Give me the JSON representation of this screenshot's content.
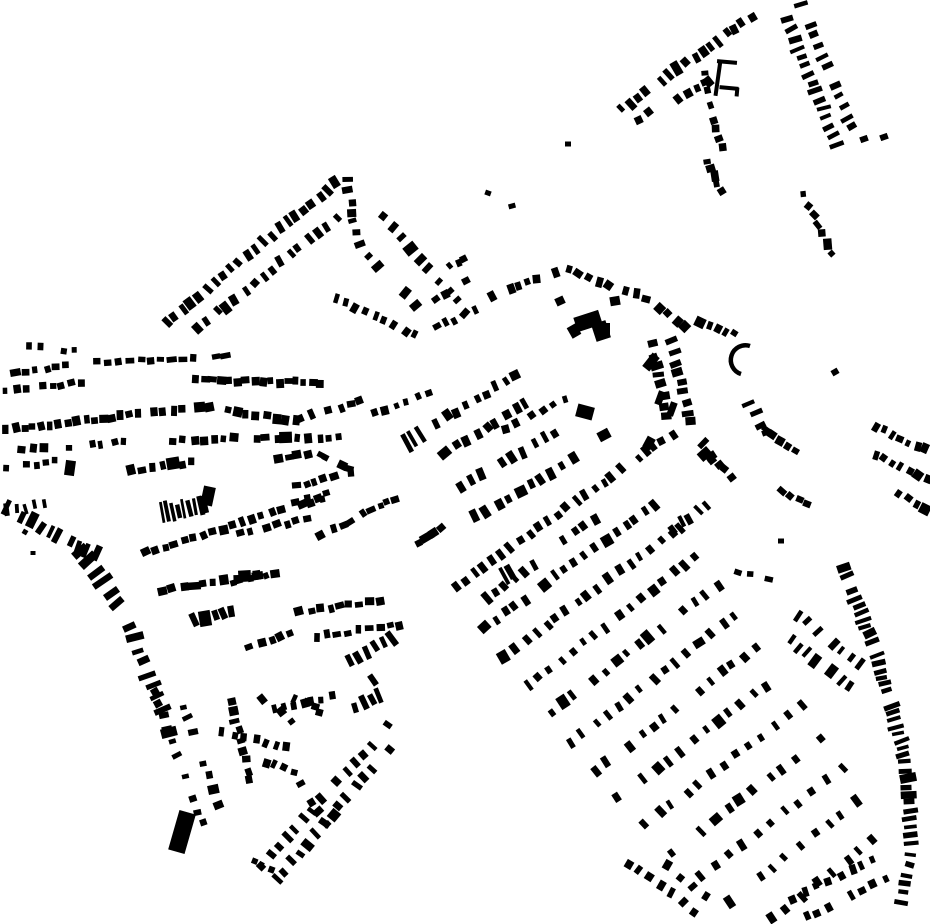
{
  "map": {
    "width": 930,
    "height": 924,
    "background_color": "#ffffff",
    "building_color": "#000000",
    "kind": "figure-ground building footprint map",
    "rows": [
      [
        618,
        112,
        755,
        14,
        17,
        6,
        10,
        10,
        0.06
      ],
      [
        633,
        122,
        712,
        80,
        8,
        6,
        9,
        12,
        0.15
      ],
      [
        703,
        68,
        722,
        150,
        10,
        6,
        7,
        14,
        0.08
      ],
      [
        706,
        158,
        722,
        196,
        5,
        6,
        7,
        14,
        0.1
      ],
      [
        782,
        8,
        838,
        148,
        16,
        5,
        12,
        8,
        0.06
      ],
      [
        800,
        0,
        854,
        132,
        13,
        5,
        11,
        8,
        0.12
      ],
      [
        797,
        180,
        835,
        258,
        8,
        7,
        6,
        25,
        0.1
      ],
      [
        348,
        173,
        162,
        325,
        23,
        6,
        10,
        10,
        0.05
      ],
      [
        340,
        215,
        185,
        338,
        17,
        6,
        9,
        10,
        0.1
      ],
      [
        346,
        176,
        359,
        248,
        7,
        6,
        9,
        10,
        0.05
      ],
      [
        372,
        200,
        470,
        318,
        11,
        6,
        9,
        12,
        0.08
      ],
      [
        363,
        250,
        420,
        310,
        6,
        6,
        9,
        12,
        0.1
      ],
      [
        330,
        295,
        420,
        338,
        9,
        6,
        9,
        12,
        0.08
      ],
      [
        480,
        300,
        560,
        272,
        9,
        7,
        8,
        14,
        0.1
      ],
      [
        565,
        268,
        650,
        300,
        9,
        7,
        8,
        14,
        0.1
      ],
      [
        655,
        305,
        690,
        330,
        4,
        7,
        8,
        14,
        0.1
      ],
      [
        648,
        330,
        668,
        420,
        9,
        6,
        10,
        10,
        0.08
      ],
      [
        670,
        337,
        692,
        428,
        9,
        6,
        10,
        10,
        0.08
      ],
      [
        692,
        430,
        722,
        468,
        4,
        6,
        10,
        10,
        0.1
      ],
      [
        700,
        448,
        736,
        482,
        4,
        6,
        9,
        10,
        0.1
      ],
      [
        668,
        533,
        720,
        496,
        6,
        5,
        10,
        10,
        0.08
      ],
      [
        735,
        572,
        772,
        580,
        4,
        7,
        5,
        10,
        0.1
      ],
      [
        795,
        612,
        865,
        668,
        8,
        5,
        10,
        9,
        0.08
      ],
      [
        786,
        636,
        852,
        690,
        8,
        5,
        10,
        9,
        0.1
      ],
      [
        762,
        425,
        800,
        455,
        5,
        7,
        7,
        12,
        0.08
      ],
      [
        780,
        488,
        812,
        508,
        4,
        7,
        7,
        12,
        0.08
      ],
      [
        862,
        420,
        930,
        452,
        8,
        6,
        8,
        10,
        0.12
      ],
      [
        872,
        452,
        930,
        482,
        7,
        6,
        8,
        10,
        0.12
      ],
      [
        884,
        484,
        930,
        512,
        5,
        6,
        8,
        10,
        0.15
      ],
      [
        25,
        345,
        80,
        352,
        5,
        6,
        6,
        15,
        0.15
      ],
      [
        12,
        372,
        70,
        366,
        6,
        6,
        7,
        12,
        0.1
      ],
      [
        2,
        390,
        85,
        383,
        9,
        6,
        7,
        10,
        0.08
      ],
      [
        2,
        430,
        143,
        414,
        16,
        7,
        8,
        8,
        0.05
      ],
      [
        150,
        412,
        215,
        407,
        7,
        7,
        8,
        8,
        0.06
      ],
      [
        222,
        410,
        300,
        422,
        8,
        7,
        8,
        8,
        0.1
      ],
      [
        18,
        450,
        130,
        442,
        10,
        6,
        7,
        12,
        0.2
      ],
      [
        92,
        362,
        230,
        357,
        13,
        8,
        6,
        10,
        0.15
      ],
      [
        192,
        380,
        325,
        383,
        16,
        7,
        7,
        6,
        0.02
      ],
      [
        159,
        514,
        208,
        503,
        9,
        3.5,
        17,
        4,
        0.04
      ],
      [
        2,
        505,
        62,
        538,
        7,
        5,
        13,
        8,
        0.08
      ],
      [
        66,
        540,
        100,
        556,
        4,
        5,
        12,
        8,
        0.1
      ],
      [
        76,
        546,
        128,
        618,
        7,
        7,
        18,
        7,
        0.05
      ],
      [
        128,
        620,
        172,
        740,
        10,
        6,
        14,
        8,
        0.08
      ],
      [
        152,
        688,
        205,
        830,
        12,
        6,
        8,
        10,
        0.15
      ],
      [
        176,
        684,
        222,
        812,
        9,
        6,
        8,
        12,
        0.25
      ],
      [
        3,
        512,
        48,
        503,
        5,
        4,
        11,
        8,
        0.1
      ],
      [
        168,
        440,
        355,
        437,
        18,
        7,
        8,
        7,
        0.06
      ],
      [
        118,
        472,
        196,
        462,
        8,
        7,
        8,
        9,
        0.1
      ],
      [
        273,
        460,
        312,
        454,
        4,
        7,
        7,
        9,
        0.1
      ],
      [
        315,
        452,
        355,
        470,
        5,
        7,
        7,
        9,
        0.1
      ],
      [
        140,
        555,
        325,
        497,
        19,
        7,
        8,
        8,
        0.06
      ],
      [
        158,
        592,
        260,
        574,
        10,
        7,
        8,
        8,
        0.1
      ],
      [
        295,
        420,
        365,
        400,
        7,
        7,
        8,
        10,
        0.1
      ],
      [
        370,
        414,
        432,
        392,
        6,
        6,
        7,
        12,
        0.1
      ],
      [
        402,
        446,
        426,
        432,
        3,
        4,
        16,
        5,
        0.05
      ],
      [
        292,
        487,
        355,
        472,
        7,
        7,
        7,
        9,
        0.08
      ],
      [
        292,
        505,
        332,
        492,
        4,
        7,
        7,
        9,
        0.1
      ],
      [
        235,
        535,
        310,
        518,
        8,
        7,
        7,
        10,
        0.1
      ],
      [
        315,
        538,
        355,
        520,
        5,
        7,
        7,
        10,
        0.1
      ],
      [
        360,
        515,
        400,
        496,
        5,
        7,
        7,
        10,
        0.1
      ],
      [
        408,
        548,
        445,
        525,
        5,
        7,
        7,
        10,
        0.1
      ],
      [
        228,
        585,
        288,
        569,
        7,
        7,
        7,
        9,
        0.08
      ],
      [
        182,
        625,
        237,
        608,
        6,
        7,
        12,
        8,
        0.06
      ],
      [
        245,
        650,
        296,
        630,
        5,
        7,
        7,
        10,
        0.1
      ],
      [
        295,
        612,
        385,
        600,
        9,
        7,
        7,
        9,
        0.08
      ],
      [
        300,
        638,
        405,
        625,
        10,
        7,
        7,
        9,
        0.08
      ],
      [
        345,
        665,
        395,
        636,
        6,
        5,
        13,
        7,
        0.08
      ],
      [
        350,
        708,
        383,
        694,
        4,
        5,
        12,
        8,
        0.1
      ],
      [
        230,
        695,
        251,
        786,
        9,
        6,
        8,
        10,
        0.1
      ],
      [
        258,
        694,
        296,
        724,
        4,
        7,
        7,
        20,
        0.1
      ],
      [
        292,
        696,
        326,
        714,
        4,
        6,
        7,
        20,
        0.15
      ],
      [
        270,
        710,
        336,
        696,
        7,
        6,
        7,
        10,
        0.1
      ],
      [
        218,
        730,
        292,
        748,
        7,
        6,
        8,
        10,
        0.1
      ],
      [
        252,
        756,
        298,
        774,
        5,
        6,
        7,
        10,
        0.1
      ],
      [
        296,
        778,
        330,
        828,
        5,
        6,
        8,
        10,
        0.1
      ],
      [
        250,
        858,
        274,
        872,
        3,
        6,
        7,
        12,
        0.1
      ],
      [
        258,
        870,
        392,
        722,
        16,
        5.5,
        10,
        7,
        0.06
      ],
      [
        272,
        884,
        400,
        737,
        16,
        5.5,
        10,
        7,
        0.06
      ],
      [
        432,
        426,
        521,
        372,
        9,
        6,
        9,
        10,
        0.08
      ],
      [
        441,
        456,
        531,
        400,
        9,
        6,
        9,
        10,
        0.08
      ],
      [
        455,
        490,
        560,
        430,
        10,
        6,
        10,
        8,
        0.06
      ],
      [
        470,
        520,
        580,
        456,
        10,
        6,
        10,
        8,
        0.06
      ],
      [
        500,
        430,
        570,
        396,
        6,
        6,
        7,
        12,
        0.2
      ],
      [
        432,
        300,
        470,
        280,
        4,
        6,
        7,
        12,
        0.1
      ],
      [
        432,
        330,
        478,
        308,
        5,
        6,
        7,
        12,
        0.1
      ],
      [
        447,
        268,
        468,
        256,
        3,
        5,
        6,
        12,
        0.1
      ],
      [
        695,
        320,
        748,
        338,
        6,
        6,
        7,
        15,
        0.1
      ],
      [
        748,
        400,
        768,
        438,
        4,
        5,
        11,
        8,
        0.1
      ],
      [
        500,
        578,
        516,
        570,
        2,
        4,
        15,
        5,
        0
      ],
      [
        2,
        468,
        60,
        461,
        6,
        6,
        6,
        12,
        0.25
      ],
      [
        452,
        590,
        570,
        505,
        13,
        5.5,
        9,
        8,
        0.06
      ],
      [
        573,
        503,
        676,
        432,
        12,
        5.5,
        9,
        8,
        0.06
      ],
      [
        470,
        610,
        600,
        515,
        13,
        5.5,
        9,
        8,
        0.2
      ],
      [
        480,
        632,
        660,
        500,
        18,
        5.5,
        9,
        7,
        0.08
      ],
      [
        500,
        660,
        686,
        522,
        18,
        5.5,
        9,
        7,
        0.1
      ],
      [
        522,
        690,
        702,
        552,
        16,
        5.5,
        9,
        7,
        0.08
      ],
      [
        545,
        717,
        722,
        582,
        16,
        5.5,
        9,
        7,
        0.08
      ],
      [
        566,
        746,
        740,
        612,
        15,
        5.5,
        9,
        7,
        0.08
      ],
      [
        590,
        776,
        762,
        642,
        15,
        5.5,
        9,
        7,
        0.08
      ],
      [
        613,
        801,
        786,
        671,
        14,
        5.5,
        9,
        7,
        0.08
      ],
      [
        640,
        828,
        808,
        701,
        13,
        5.5,
        9,
        7,
        0.08
      ],
      [
        666,
        856,
        830,
        731,
        12,
        5.5,
        9,
        7,
        0.08
      ],
      [
        696,
        881,
        848,
        763,
        11,
        5.5,
        9,
        7,
        0.1
      ],
      [
        726,
        906,
        862,
        796,
        10,
        5.5,
        9,
        7,
        0.1
      ],
      [
        766,
        924,
        882,
        832,
        8,
        5.5,
        9,
        7,
        0.1
      ],
      [
        788,
        900,
        880,
        856,
        8,
        6,
        8,
        9,
        0.1
      ],
      [
        800,
        920,
        892,
        876,
        8,
        6,
        8,
        9,
        0.1
      ],
      [
        622,
        858,
        700,
        915,
        7,
        6,
        8,
        10,
        0.2
      ],
      [
        648,
        850,
        710,
        900,
        5,
        6,
        8,
        12,
        0.3
      ],
      [
        843,
        565,
        878,
        660,
        13,
        4.5,
        13,
        6,
        0.05
      ],
      [
        878,
        660,
        905,
        758,
        14,
        4.5,
        13,
        6,
        0.05
      ],
      [
        905,
        758,
        913,
        846,
        11,
        4.5,
        12,
        6,
        0.05
      ],
      [
        911,
        850,
        899,
        918,
        7,
        4.5,
        11,
        8,
        0.2
      ]
    ],
    "blocks": [
      [
        588,
        321,
        26,
        15,
        -18
      ],
      [
        601,
        331,
        15,
        18,
        -18
      ],
      [
        574,
        331,
        10,
        12,
        -30
      ],
      [
        615,
        301,
        10,
        9,
        -10
      ],
      [
        560,
        301,
        9,
        8,
        -25
      ],
      [
        604,
        330,
        12,
        14,
        0
      ],
      [
        585,
        412,
        17,
        13,
        15
      ],
      [
        651,
        362,
        9,
        17,
        38
      ],
      [
        182,
        832,
        17,
        41,
        16
      ],
      [
        70,
        468,
        10,
        15,
        8
      ],
      [
        208,
        496,
        12,
        19,
        12
      ],
      [
        660,
        398,
        7,
        14,
        20
      ],
      [
        672,
        409,
        7,
        14,
        20
      ],
      [
        604,
        435,
        12,
        10,
        -28
      ],
      [
        649,
        443,
        9,
        12,
        28
      ],
      [
        718,
        78,
        4,
        36,
        8
      ],
      [
        727,
        62,
        20,
        4,
        5
      ],
      [
        729,
        88,
        19,
        4,
        5
      ],
      [
        737,
        92,
        4,
        9,
        5
      ],
      [
        568,
        144,
        6,
        5,
        0
      ],
      [
        488,
        193,
        6,
        5,
        20
      ],
      [
        512,
        206,
        7,
        5,
        -15
      ],
      [
        864,
        139,
        8,
        6,
        -20
      ],
      [
        884,
        137,
        8,
        6,
        -20
      ],
      [
        835,
        372,
        7,
        6,
        -30
      ],
      [
        781,
        541,
        6,
        5,
        0
      ],
      [
        25,
        532,
        5,
        5,
        30
      ],
      [
        33,
        553,
        5,
        4,
        0
      ],
      [
        373,
        680,
        6,
        12,
        -35
      ]
    ],
    "arcs": [
      [
        750,
        346,
        741,
        374,
        14,
        0,
        0,
        4.5
      ]
    ]
  }
}
